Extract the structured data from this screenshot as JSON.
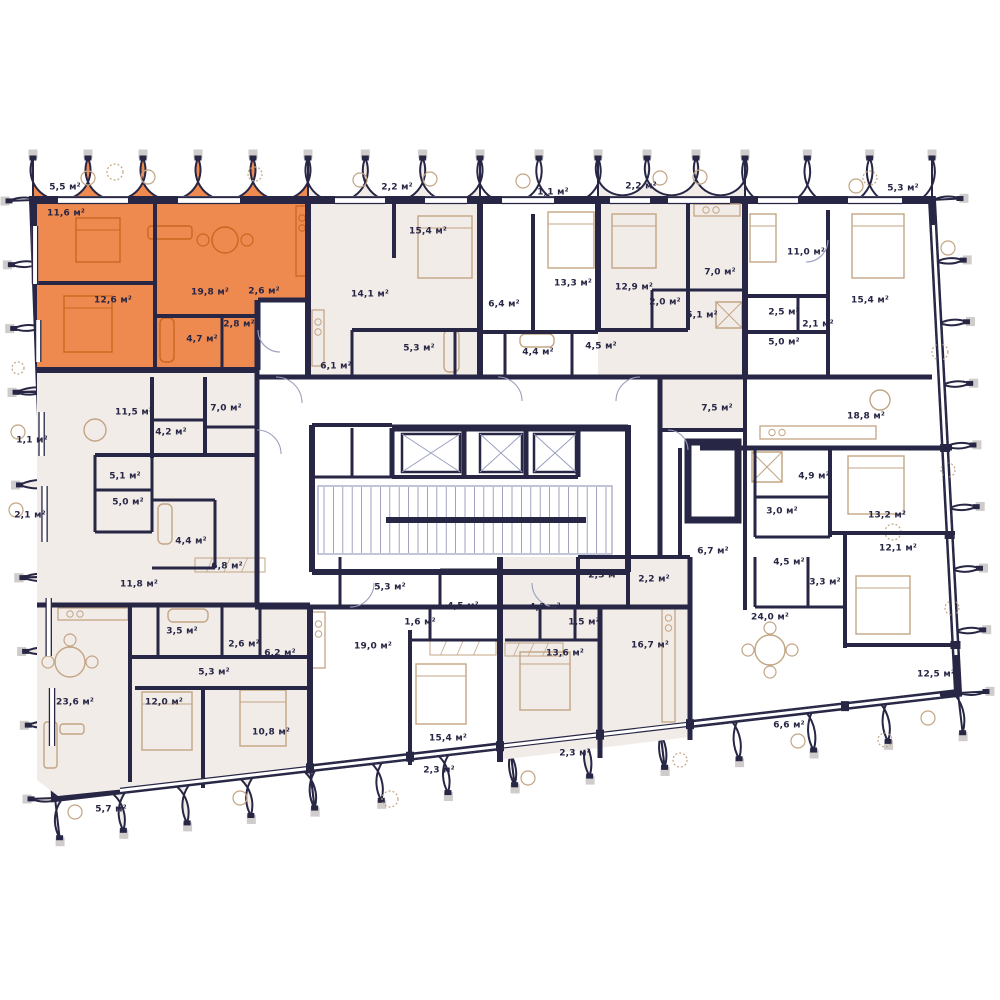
{
  "plan": {
    "type": "residential-floor-plan",
    "unit": "м²",
    "colors": {
      "wall": "#272645",
      "highlight": "#EE8A50",
      "highlight_line": "#C9671F",
      "tint": "#F2ECE9",
      "tint_dark": "#EFE8E3",
      "furniture": "#C3A584",
      "thin_line": "#9A9FBF",
      "post": "#CFCCCB"
    },
    "highlighted_apartment": {
      "room_areas": [
        "5,5 м²",
        "11,6 м²",
        "12,6 м²",
        "19,8 м²",
        "2,6 м²",
        "2,8 м²",
        "4,7 м²"
      ]
    },
    "rooms": [
      {
        "area": "5,5 м²",
        "x": 65,
        "y": 188
      },
      {
        "area": "11,6 м²",
        "x": 66,
        "y": 214
      },
      {
        "area": "12,6 м²",
        "x": 113,
        "y": 301
      },
      {
        "area": "19,8 м²",
        "x": 210,
        "y": 293
      },
      {
        "area": "2,6 м²",
        "x": 264,
        "y": 292
      },
      {
        "area": "2,8 м²",
        "x": 239,
        "y": 325
      },
      {
        "area": "4,7 м²",
        "x": 202,
        "y": 340
      },
      {
        "area": "2,2 м²",
        "x": 397,
        "y": 188
      },
      {
        "area": "15,4 м²",
        "x": 428,
        "y": 232
      },
      {
        "area": "14,1 м²",
        "x": 370,
        "y": 295
      },
      {
        "area": "5,3 м²",
        "x": 419,
        "y": 349
      },
      {
        "area": "6,1 м²",
        "x": 336,
        "y": 367
      },
      {
        "area": "1,1 м²",
        "x": 553,
        "y": 193
      },
      {
        "area": "13,3 м²",
        "x": 573,
        "y": 284
      },
      {
        "area": "6,4 м²",
        "x": 504,
        "y": 305
      },
      {
        "area": "4,4 м²",
        "x": 538,
        "y": 353
      },
      {
        "area": "2,2 м²",
        "x": 641,
        "y": 187
      },
      {
        "area": "12,9 м²",
        "x": 634,
        "y": 288
      },
      {
        "area": "2,0 м²",
        "x": 665,
        "y": 303
      },
      {
        "area": "5,1 м²",
        "x": 702,
        "y": 316
      },
      {
        "area": "7,0 м²",
        "x": 720,
        "y": 273
      },
      {
        "area": "4,5 м²",
        "x": 601,
        "y": 347
      },
      {
        "area": "5,3 м²",
        "x": 903,
        "y": 189
      },
      {
        "area": "11,0 м²",
        "x": 806,
        "y": 253
      },
      {
        "area": "2,5 м²",
        "x": 784,
        "y": 313
      },
      {
        "area": "2,1 м²",
        "x": 818,
        "y": 325
      },
      {
        "area": "5,0 м²",
        "x": 784,
        "y": 343
      },
      {
        "area": "15,4 м²",
        "x": 870,
        "y": 301
      },
      {
        "area": "7,5 м²",
        "x": 717,
        "y": 409
      },
      {
        "area": "18,8 м²",
        "x": 866,
        "y": 417
      },
      {
        "area": "4,9 м²",
        "x": 814,
        "y": 477
      },
      {
        "area": "3,0 м²",
        "x": 782,
        "y": 512
      },
      {
        "area": "13,2 м²",
        "x": 887,
        "y": 516
      },
      {
        "area": "6,7 м²",
        "x": 713,
        "y": 552
      },
      {
        "area": "4,5 м²",
        "x": 789,
        "y": 563
      },
      {
        "area": "3,3 м²",
        "x": 825,
        "y": 583
      },
      {
        "area": "12,1 м²",
        "x": 898,
        "y": 549
      },
      {
        "area": "24,0 м²",
        "x": 770,
        "y": 618
      },
      {
        "area": "12,5 м²",
        "x": 936,
        "y": 675
      },
      {
        "area": "6,6 м²",
        "x": 789,
        "y": 726
      },
      {
        "area": "16,7 м²",
        "x": 650,
        "y": 646
      },
      {
        "area": "2,2 м²",
        "x": 654,
        "y": 580
      },
      {
        "area": "2,3 м²",
        "x": 604,
        "y": 576
      },
      {
        "area": "1,1 м²",
        "x": 32,
        "y": 441
      },
      {
        "area": "11,5 м²",
        "x": 134,
        "y": 413
      },
      {
        "area": "7,0 м²",
        "x": 226,
        "y": 409
      },
      {
        "area": "4,2 м²",
        "x": 171,
        "y": 433
      },
      {
        "area": "5,1 м²",
        "x": 125,
        "y": 477
      },
      {
        "area": "5,0 м²",
        "x": 128,
        "y": 503
      },
      {
        "area": "2,1 м²",
        "x": 30,
        "y": 516
      },
      {
        "area": "4,4 м²",
        "x": 191,
        "y": 542
      },
      {
        "area": "6,8 м²",
        "x": 227,
        "y": 567
      },
      {
        "area": "11,8 м²",
        "x": 139,
        "y": 585
      },
      {
        "area": "3,5 м²",
        "x": 182,
        "y": 632
      },
      {
        "area": "2,6 м²",
        "x": 244,
        "y": 645
      },
      {
        "area": "6,2 м²",
        "x": 280,
        "y": 654
      },
      {
        "area": "5,3 м²",
        "x": 214,
        "y": 673
      },
      {
        "area": "23,6 м²",
        "x": 75,
        "y": 703
      },
      {
        "area": "12,0 м²",
        "x": 164,
        "y": 703
      },
      {
        "area": "10,8 м²",
        "x": 271,
        "y": 733
      },
      {
        "area": "5,7 м²",
        "x": 111,
        "y": 810
      },
      {
        "area": "5,3 м²",
        "x": 390,
        "y": 588
      },
      {
        "area": "4,5 м²",
        "x": 463,
        "y": 607
      },
      {
        "area": "4,3 м²",
        "x": 545,
        "y": 608
      },
      {
        "area": "1,6 м²",
        "x": 420,
        "y": 623
      },
      {
        "area": "1,5 м²",
        "x": 584,
        "y": 623
      },
      {
        "area": "19,0 м²",
        "x": 373,
        "y": 647
      },
      {
        "area": "13,6 м²",
        "x": 565,
        "y": 654
      },
      {
        "area": "15,4 м²",
        "x": 448,
        "y": 739
      },
      {
        "area": "2,3 м²",
        "x": 439,
        "y": 771
      },
      {
        "area": "2,3 м²",
        "x": 575,
        "y": 754
      }
    ]
  }
}
